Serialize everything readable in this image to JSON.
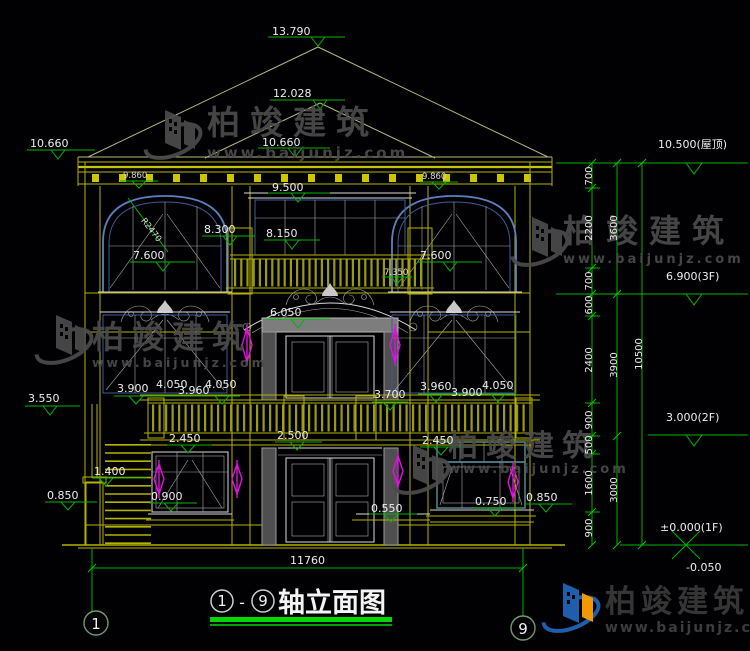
{
  "watermark": {
    "brand": "柏竣建筑",
    "url": "www.baijunjz.com"
  },
  "title_block": {
    "title": "轴立面图",
    "dash": "-"
  },
  "axis": {
    "left": "1",
    "right": "9"
  },
  "overall_width": "11760",
  "levels": {
    "roof": "10.500(屋顶)",
    "f3": "6.900(3F)",
    "f2": "3.000(2F)",
    "f1": "±0.000(1F)",
    "below": "-0.050"
  },
  "chain": {
    "s0": "700",
    "s1": "2200",
    "s2": "700",
    "s3": "600",
    "s4": "2400",
    "s5": "900",
    "s6": "500",
    "s7": "1600",
    "s8": "900",
    "t0": "3600",
    "t1": "3900",
    "t2": "3000",
    "total": "10500"
  },
  "marks": {
    "m13790": "13.790",
    "m12028": "12.028",
    "m10660l": "10.660",
    "m10660c": "10.660",
    "m9860l": "9.860",
    "m9860r": "9.860",
    "m9500": "9.500",
    "m8300": "8.300",
    "m8150": "8.150",
    "m7600l": "7.600",
    "m7600r": "7.600",
    "m7350": "7.350",
    "m6050": "6.050",
    "r2470": "R2470",
    "m3550": "3.550",
    "m3900l": "3.900",
    "m4050l1": "4.050",
    "m3960l": "3.960",
    "m4050l2": "4.050",
    "m3700": "3.700",
    "m3960r": "3.960",
    "m3900r": "3.900",
    "m4050r": "4.050",
    "m2450l": "2.450",
    "m2500": "2.500",
    "m2450r": "2.450",
    "m1400": "1.400",
    "m0850l": "0.850",
    "m0900": "0.900",
    "m0550": "0.550",
    "m0750": "0.750",
    "m0850r": "0.850"
  }
}
